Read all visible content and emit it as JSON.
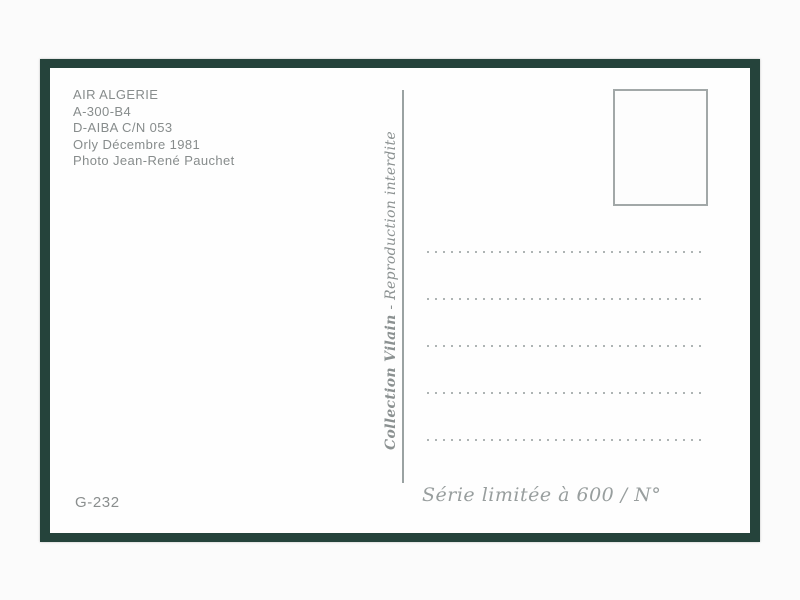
{
  "card": {
    "info_block": {
      "lines": [
        "AIR ALGERIE",
        "A-300-B4",
        "D-AIBA C/N 053",
        "Orly Décembre 1981",
        "Photo Jean-René Pauchet"
      ]
    },
    "publisher": {
      "name": "Collection Vilain",
      "separator": " - ",
      "notice": "Reproduction interdite"
    },
    "stamp_box": {
      "present": true
    },
    "address_area": {
      "dotted_lines_count": 5
    },
    "ref_number": "G-232",
    "series_note": "Série limitée à 600 / N°"
  },
  "colors": {
    "frame_green": "#25433b",
    "card_white": "#fefefe",
    "text_gray": "#878c8c",
    "script_gray": "#8b9191",
    "line_gray": "#9aa2a2",
    "dot_gray": "#aeb4b4"
  }
}
